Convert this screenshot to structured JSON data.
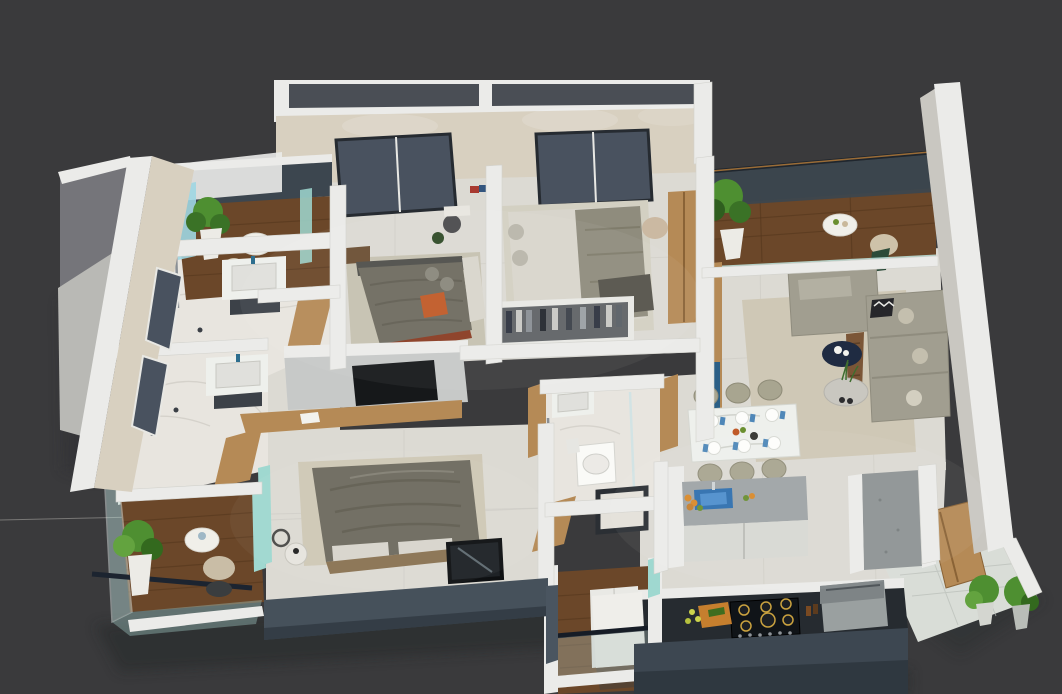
{
  "title": "3 BHK 3D CUT SECTION",
  "palette": {
    "bg": "#3a3a3c",
    "titleColor": "#ffffff",
    "wallTop": "#ebebe9",
    "wallCream": "#d8d0c0",
    "wallGray": "#75757a",
    "wallInner": "#c9c7c1",
    "floorTile": "#dcdad3",
    "floorMarble": "#e8e5df",
    "woodDark": "#6b4729",
    "woodLine": "#53351c",
    "woodFurn": "#b58a56",
    "glassTeal": "#9fd8d0",
    "glassSlate": "#3c464f",
    "windowGlass": "#49525f",
    "slateFront": "#46515b",
    "counterDark": "#262b30",
    "sofa": "#a19e90",
    "rug": "#cfc8b6",
    "bedDark": "#6e6b5f",
    "bedLight": "#d8d5cc",
    "accentOrange": "#c05a28",
    "plant": "#4e8f31",
    "plantDark": "#2f5e1f",
    "pot": "#ecebe6",
    "navy": "#1f2b42",
    "chairOlive": "#a8a590",
    "marbleWhite": "#eef0ec",
    "applianceGray": "#9aa0a0",
    "sinkBlue": "#2f6fae",
    "boardOrange": "#c67f2e",
    "burnerBrass": "#caa23f"
  },
  "scene": {
    "type": "isometric-cut-section-floor-plan",
    "rooms": [
      {
        "id": "balcony-top-left",
        "features": [
          "wood-floor",
          "plant",
          "round-table",
          "glass-balustrade"
        ]
      },
      {
        "id": "bathroom-upper",
        "features": [
          "marble-floor",
          "vanity-sink",
          "shower",
          "wood-door"
        ]
      },
      {
        "id": "bathroom-lower",
        "features": [
          "marble-floor",
          "vanity-sink",
          "shower",
          "wood-door"
        ]
      },
      {
        "id": "bedroom-left",
        "features": [
          "window",
          "bed",
          "office-chair",
          "rug"
        ]
      },
      {
        "id": "bedroom-right",
        "features": [
          "window",
          "bed",
          "open-wardrobe",
          "armoire"
        ]
      },
      {
        "id": "balcony-right",
        "features": [
          "wood-floor",
          "plant",
          "round-table",
          "armchair",
          "glass-railing"
        ]
      },
      {
        "id": "living-room",
        "features": [
          "sectional-sofa",
          "coffee-tables",
          "rug",
          "tv-unit"
        ]
      },
      {
        "id": "dining-area",
        "features": [
          "marble-table",
          "six-chairs",
          "plates"
        ]
      },
      {
        "id": "kitchen",
        "features": [
          "island-sink",
          "gas-hob",
          "chimney",
          "pantry-column",
          "dark-counter"
        ]
      },
      {
        "id": "master-bedroom",
        "features": [
          "bed",
          "rug",
          "side-table",
          "mirror",
          "tv-partition"
        ]
      },
      {
        "id": "bathroom-central",
        "features": [
          "toilet",
          "sink",
          "shower-tray",
          "glass-screen"
        ]
      },
      {
        "id": "foyer-balcony",
        "features": [
          "wood-floor",
          "white-pedestal",
          "glass-balustrade"
        ]
      },
      {
        "id": "utility-entry",
        "features": [
          "tile-floor",
          "wood-door",
          "plants"
        ]
      }
    ]
  }
}
